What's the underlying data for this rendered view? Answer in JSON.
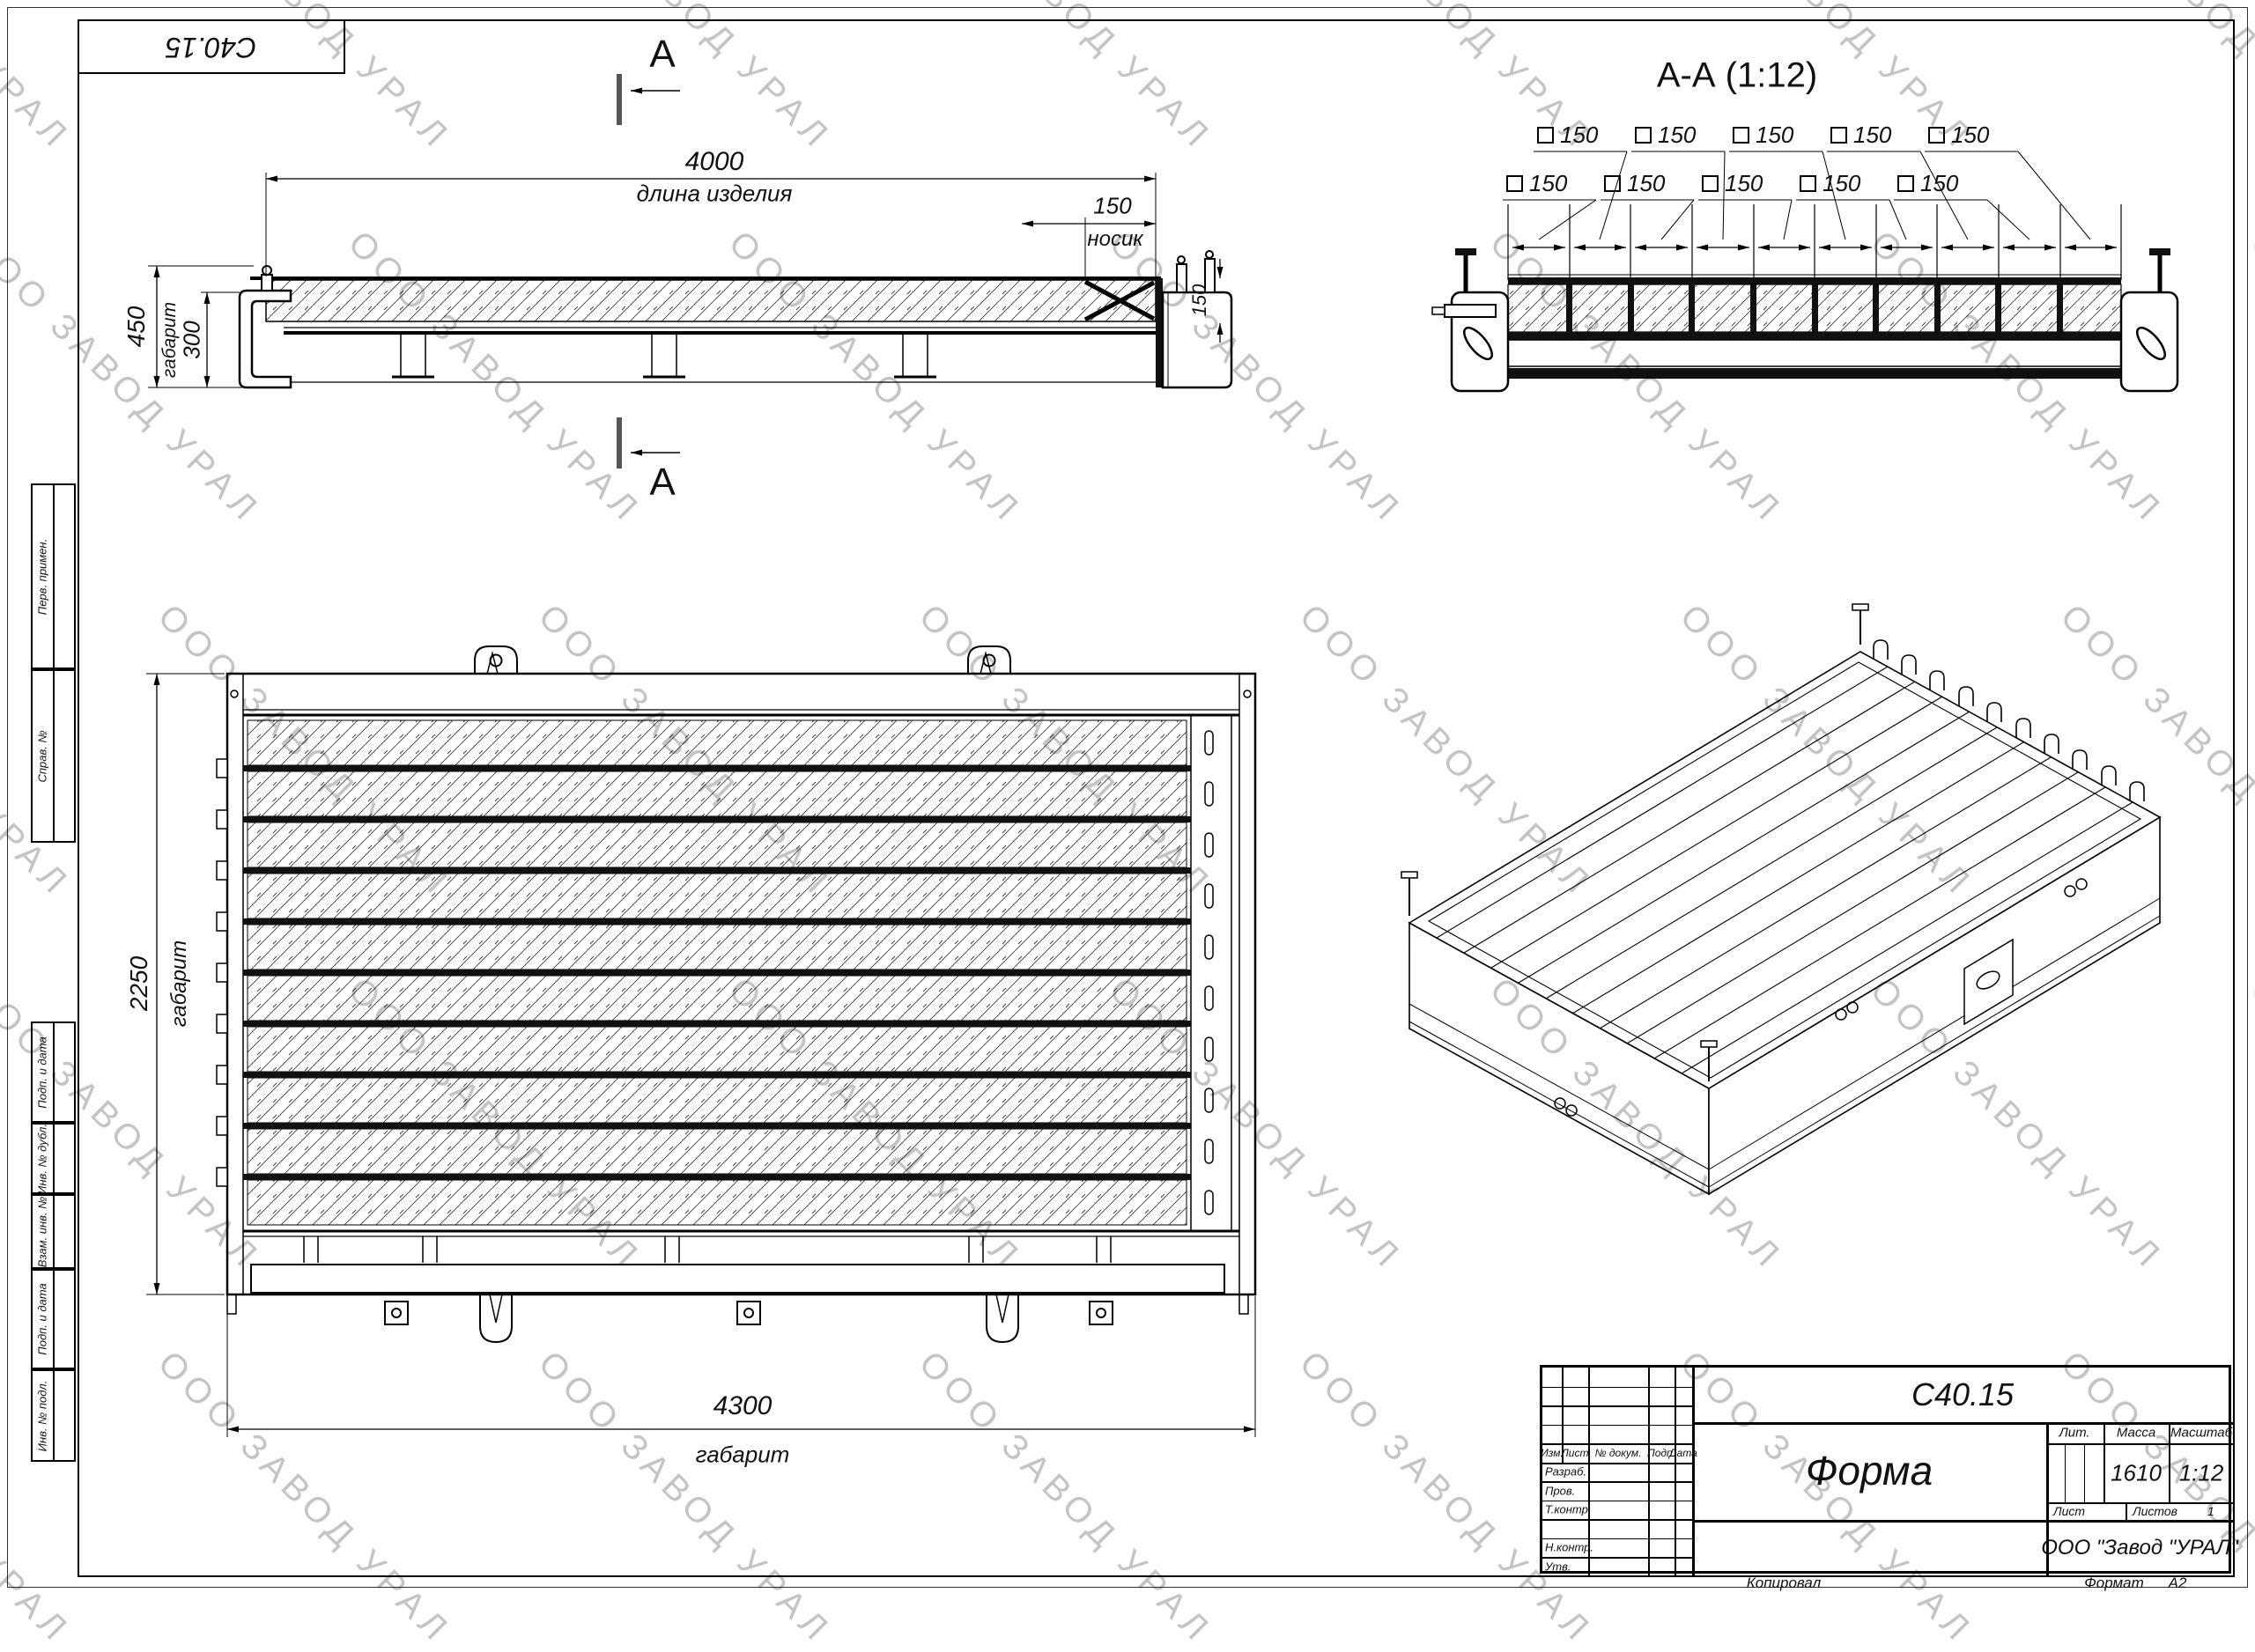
{
  "watermark": {
    "text": "ООО ЗАВОД УРАЛ"
  },
  "corner_stamp": {
    "doc_number": "С40.15"
  },
  "side_view": {
    "section_letter_top": "А",
    "section_letter_bottom": "А",
    "dim_length": "4000",
    "dim_length_label": "длина изделия",
    "dim_nose": "150",
    "dim_nose_label": "носик",
    "dim_total_height": "450",
    "dim_inner_height": "300",
    "dim_inner_height_label": "габарит",
    "dim_product_height": "150"
  },
  "section_aa": {
    "title": "А-А (1:12)",
    "cell_dims": [
      "150",
      "150",
      "150",
      "150",
      "150",
      "150",
      "150",
      "150",
      "150",
      "150"
    ]
  },
  "plan_view": {
    "dim_width": "2250",
    "dim_width_label": "габарит",
    "dim_length": "4300",
    "dim_length_label": "габарит"
  },
  "side_strip": {
    "cells": [
      "Перв. примен.",
      "Справ. №",
      "Подп. и дата",
      "Инв. № дубл.",
      "Взам. инв. №",
      "Подп. и дата",
      "Инв. № подл."
    ]
  },
  "title_block": {
    "doc_number": "С40.15",
    "title": "Форма",
    "company": "ООО \"Завод \"УРАЛ\"",
    "headers": {
      "izm": "Изм.",
      "list": "Лист",
      "doc": "№ докум.",
      "sign": "Подп.",
      "date": "Дата"
    },
    "rows": {
      "developed": "Разраб.",
      "checked": "Пров.",
      "tcontrol": "Т.контр.",
      "ncontrol": "Н.контр.",
      "approved": "Утв."
    },
    "fields": {
      "lit": "Лит.",
      "mass": "Масса",
      "scale": "Масштаб",
      "sheet": "Лист",
      "sheets": "Листов"
    },
    "values": {
      "mass": "1610",
      "scale": "1:12",
      "sheets": "1"
    },
    "footer": {
      "copied": "Копировал",
      "format_label": "Формат",
      "format_value": "А2"
    }
  }
}
